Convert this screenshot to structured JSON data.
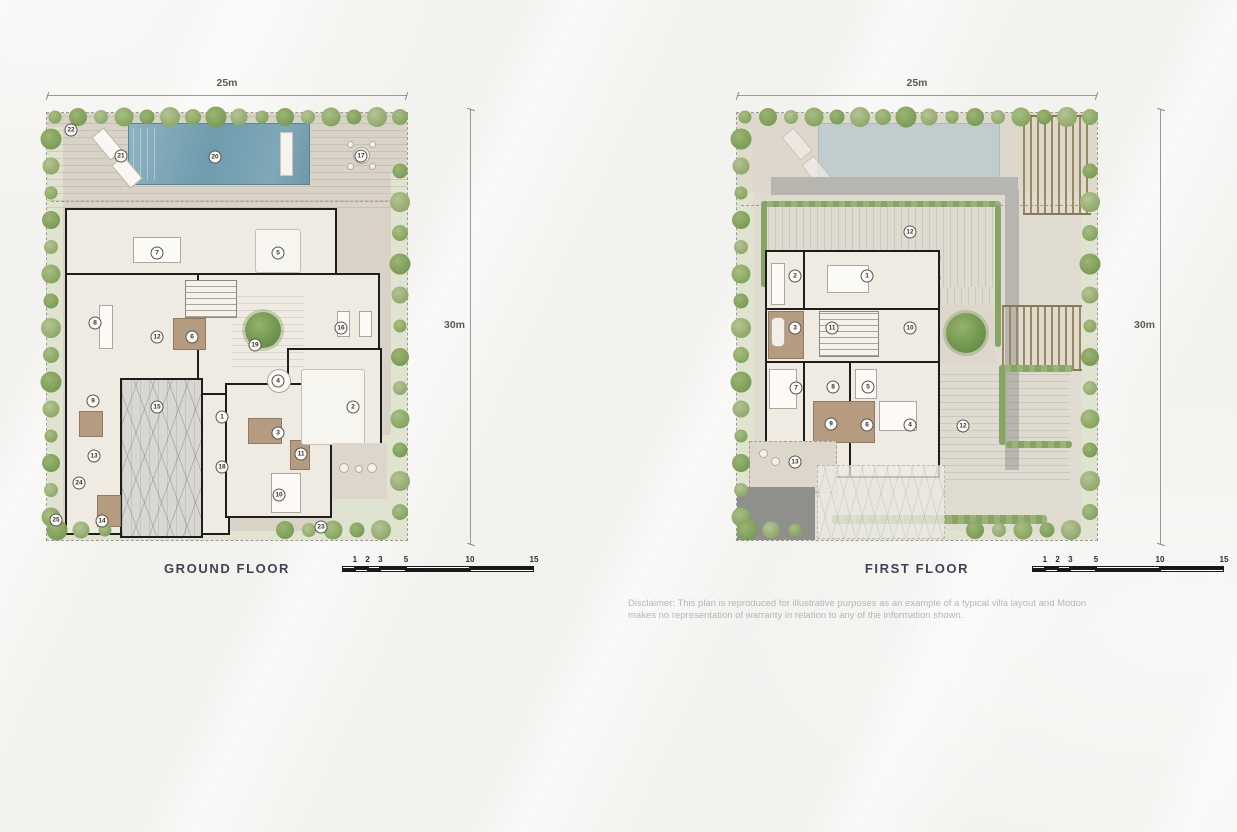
{
  "page": {
    "disclaimer": [
      "Disclaimer: This plan is reproduced for illustrative purposes as an example of a typical villa layout and Modon",
      "makes no representation of warranty in relation to any of the information shown."
    ]
  },
  "plans": [
    {
      "label": "GROUND FLOOR",
      "width_dim": "25m",
      "height_dim": "30m",
      "scale": {
        "labels": [
          "1",
          "2",
          "3",
          "5",
          "10",
          "15"
        ],
        "values": [
          1,
          2,
          3,
          5,
          10,
          15
        ]
      },
      "markers": [
        {
          "n": "1",
          "x": 175,
          "y": 304
        },
        {
          "n": "2",
          "x": 306,
          "y": 294
        },
        {
          "n": "3",
          "x": 231,
          "y": 320
        },
        {
          "n": "4",
          "x": 231,
          "y": 268
        },
        {
          "n": "5",
          "x": 231,
          "y": 140
        },
        {
          "n": "6",
          "x": 145,
          "y": 224
        },
        {
          "n": "7",
          "x": 110,
          "y": 140
        },
        {
          "n": "8",
          "x": 48,
          "y": 210
        },
        {
          "n": "9",
          "x": 46,
          "y": 288
        },
        {
          "n": "10",
          "x": 232,
          "y": 382
        },
        {
          "n": "11",
          "x": 254,
          "y": 341
        },
        {
          "n": "12",
          "x": 110,
          "y": 224
        },
        {
          "n": "13",
          "x": 47,
          "y": 343
        },
        {
          "n": "14",
          "x": 55,
          "y": 408
        },
        {
          "n": "15",
          "x": 110,
          "y": 294
        },
        {
          "n": "16",
          "x": 294,
          "y": 215
        },
        {
          "n": "17",
          "x": 314,
          "y": 43
        },
        {
          "n": "18",
          "x": 175,
          "y": 354
        },
        {
          "n": "19",
          "x": 208,
          "y": 232
        },
        {
          "n": "20",
          "x": 168,
          "y": 44
        },
        {
          "n": "21",
          "x": 74,
          "y": 43
        },
        {
          "n": "22",
          "x": 24,
          "y": 17
        },
        {
          "n": "23",
          "x": 274,
          "y": 414
        },
        {
          "n": "24",
          "x": 32,
          "y": 370
        },
        {
          "n": "25",
          "x": 9,
          "y": 407
        }
      ]
    },
    {
      "label": "FIRST FLOOR",
      "width_dim": "25m",
      "height_dim": "30m",
      "scale": {
        "labels": [
          "1",
          "2",
          "3",
          "5",
          "10",
          "15"
        ],
        "values": [
          1,
          2,
          3,
          5,
          10,
          15
        ]
      },
      "markers": [
        {
          "n": "1",
          "x": 130,
          "y": 163
        },
        {
          "n": "2",
          "x": 58,
          "y": 163
        },
        {
          "n": "3",
          "x": 58,
          "y": 215
        },
        {
          "n": "4",
          "x": 173,
          "y": 312
        },
        {
          "n": "5",
          "x": 131,
          "y": 274
        },
        {
          "n": "6",
          "x": 130,
          "y": 312
        },
        {
          "n": "7",
          "x": 59,
          "y": 275
        },
        {
          "n": "8",
          "x": 96,
          "y": 274
        },
        {
          "n": "9",
          "x": 94,
          "y": 311
        },
        {
          "n": "10",
          "x": 173,
          "y": 215
        },
        {
          "n": "11",
          "x": 95,
          "y": 215
        },
        {
          "n": "12",
          "x": 173,
          "y": 119
        },
        {
          "n": "12",
          "x": 226,
          "y": 313
        },
        {
          "n": "13",
          "x": 58,
          "y": 349
        }
      ]
    }
  ]
}
